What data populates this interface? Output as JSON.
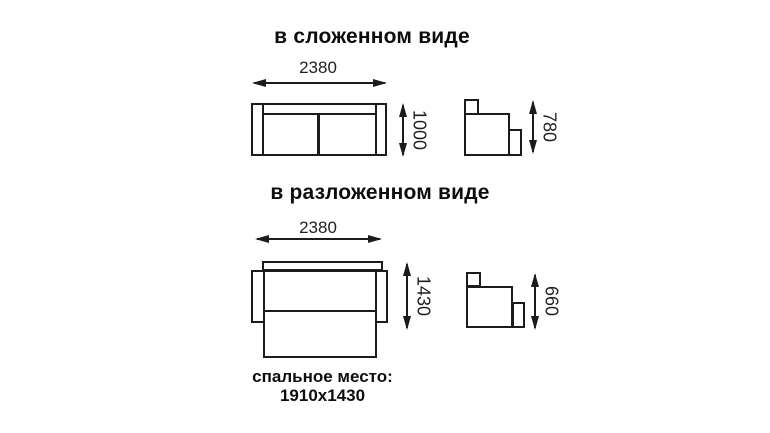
{
  "diagram": {
    "titles": {
      "folded": "в сложенном виде",
      "unfolded": "в разложенном виде"
    },
    "folded": {
      "width_mm": "2380",
      "height_mm": "1000",
      "side_height_mm": "780"
    },
    "unfolded": {
      "width_mm": "2380",
      "depth_mm": "1430",
      "side_height_mm": "660"
    },
    "caption": {
      "line1": "спальное место:",
      "line2": "1910х1430"
    },
    "icons": {
      "arrowhead": "css-triangle"
    },
    "colors": {
      "line": "#1c1c1c",
      "text": "#111111",
      "background": "#ffffff"
    }
  }
}
